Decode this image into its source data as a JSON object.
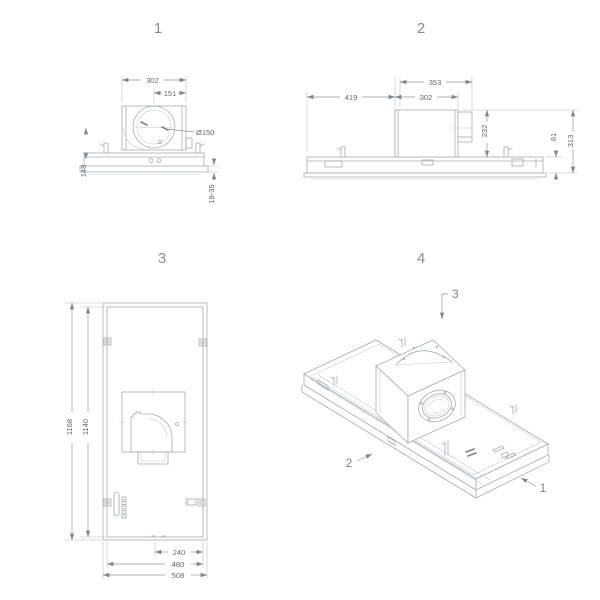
{
  "views": {
    "front": {
      "title": "1",
      "dims": {
        "width": "302",
        "half_width": "151",
        "duct_diameter": "Ø150",
        "height": "148",
        "recess": "18-35"
      }
    },
    "side": {
      "title": "2",
      "dims": {
        "motor_outlet_width": "353",
        "left_offset": "419",
        "motor_width": "302",
        "motor_height": "232",
        "body_height": "81",
        "total_height": "313"
      }
    },
    "plan": {
      "title": "3",
      "dims": {
        "outer_length": "1168",
        "inner_length": "1140",
        "half_width_offset": "240",
        "inner_width": "480",
        "outer_width": "508"
      }
    },
    "iso": {
      "title": "4",
      "callouts": {
        "top": "3",
        "left": "2",
        "right": "1"
      }
    }
  },
  "colors": {
    "line": "#a6abb0",
    "dim_text": "#636669",
    "title_text": "#8b8d90"
  }
}
